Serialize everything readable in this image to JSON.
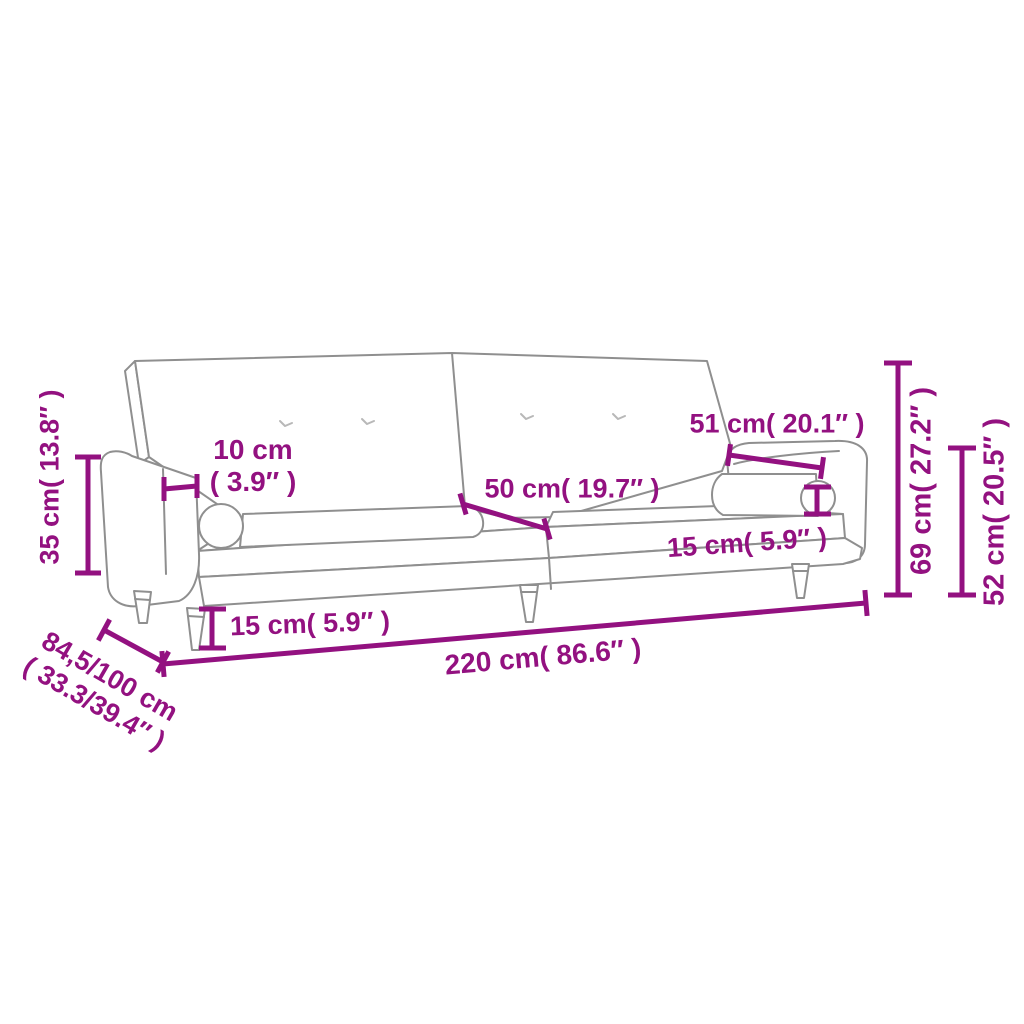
{
  "diagram": {
    "subject": "sofa-bed-dimension-line-drawing",
    "colors": {
      "dimension_annotation": "#931180",
      "drawing_outline": "#8f8f8f",
      "background": "#ffffff"
    },
    "labels": {
      "cm35": "35 cm( 13.8″ )",
      "cm10_line1": "10 cm",
      "cm10_line2": "( 3.9″ )",
      "cm50": "50 cm( 19.7″ )",
      "cm51": "51 cm( 20.1″ )",
      "cm15_bolster": "15 cm( 5.9″ )",
      "cm15_leg": "15 cm( 5.9″ )",
      "cm220": "220 cm( 86.6″ )",
      "cm845_line1": "84,5/100 cm",
      "cm845_line2": "( 33.3/39.4″ )",
      "cm69": "69 cm( 27.2″ )",
      "cm52": "52 cm( 20.5″ )"
    }
  }
}
